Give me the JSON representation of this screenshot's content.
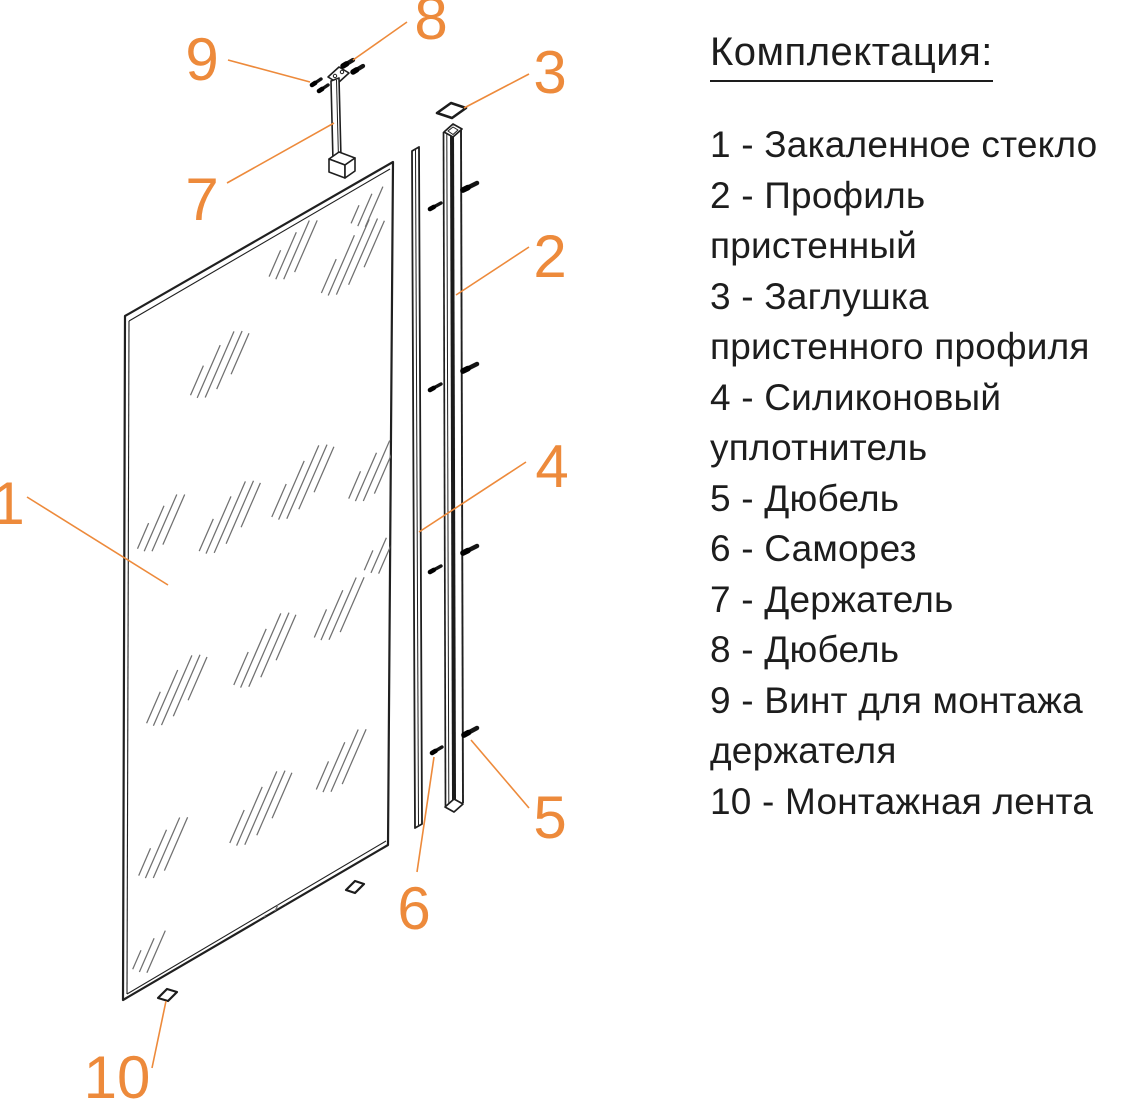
{
  "colors": {
    "accent": "#ED8A3B",
    "ink": "#1d1d1d",
    "diagram_line": "#222222",
    "hatch_gray": "#707070"
  },
  "parts_list": {
    "title": "Комплектация:",
    "items": [
      {
        "number": "1",
        "name": "Закаленное стекло",
        "lines": [
          "1 - Закаленное стекло"
        ]
      },
      {
        "number": "2",
        "name": "Профиль пристенный",
        "lines": [
          "2 - Профиль",
          "пристенный"
        ]
      },
      {
        "number": "3",
        "name": "Заглушка пристенного профиля",
        "lines": [
          "3 - Заглушка",
          "пристенного профиля"
        ]
      },
      {
        "number": "4",
        "name": "Силиконовый уплотнитель",
        "lines": [
          "4 - Силиконовый",
          "уплотнитель"
        ]
      },
      {
        "number": "5",
        "name": "Дюбель",
        "lines": [
          "5 - Дюбель"
        ]
      },
      {
        "number": "6",
        "name": "Саморез",
        "lines": [
          "6 - Саморез"
        ]
      },
      {
        "number": "7",
        "name": "Держатель",
        "lines": [
          "7 - Держатель"
        ]
      },
      {
        "number": "8",
        "name": "Дюбель",
        "lines": [
          "8 - Дюбель"
        ]
      },
      {
        "number": "9",
        "name": "Винт для монтажа держателя",
        "lines": [
          "9 - Винт для монтажа",
          "держателя"
        ]
      },
      {
        "number": "10",
        "name": "Монтажная лента",
        "lines": [
          "10 - Монтажная лента"
        ]
      }
    ]
  },
  "diagram": {
    "callouts": [
      {
        "label": "9",
        "x": 202,
        "y": 80,
        "line": [
          228,
          60,
          310,
          82
        ]
      },
      {
        "label": "8",
        "x": 431,
        "y": 39,
        "line": [
          407,
          22,
          353,
          60
        ]
      },
      {
        "label": "7",
        "x": 202,
        "y": 220,
        "line": [
          227,
          183,
          334,
          123
        ]
      },
      {
        "label": "3",
        "x": 550,
        "y": 93,
        "line": [
          529,
          74,
          464,
          108
        ]
      },
      {
        "label": "2",
        "x": 550,
        "y": 277,
        "line": [
          529,
          247,
          456,
          295
        ]
      },
      {
        "label": "4",
        "x": 552,
        "y": 487,
        "line": [
          526,
          462,
          419,
          532
        ]
      },
      {
        "label": "1",
        "x": 8,
        "y": 524,
        "line": [
          27,
          497,
          168,
          585
        ]
      },
      {
        "label": "5",
        "x": 550,
        "y": 838,
        "line": [
          529,
          808,
          471,
          740
        ]
      },
      {
        "label": "6",
        "x": 414,
        "y": 929,
        "line": [
          434,
          757,
          417,
          872
        ]
      },
      {
        "label": "10",
        "x": 117,
        "y": 1098,
        "line": [
          166,
          1001,
          152,
          1068
        ]
      }
    ]
  }
}
